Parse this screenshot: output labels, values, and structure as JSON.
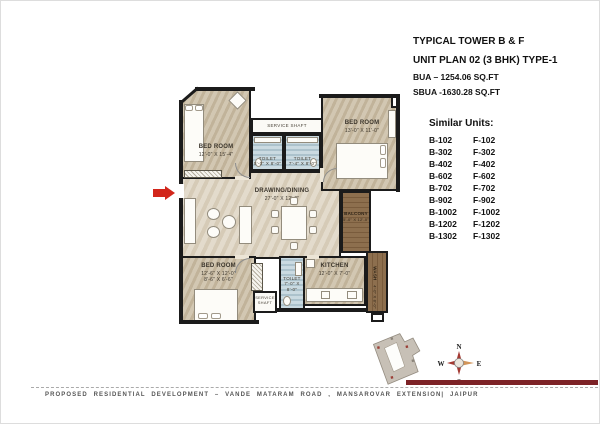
{
  "header": {
    "line1": "TYPICAL TOWER B & F",
    "line2": "UNIT PLAN 02 (3 BHK) TYPE-1",
    "line3": "BUA – 1254.06 SQ.FT",
    "line4": "SBUA -1630.28 SQ.FT"
  },
  "similar_units": {
    "title": "Similar Units:",
    "rows": [
      {
        "b": "B-102",
        "f": "F-102"
      },
      {
        "b": "B-302",
        "f": "F-302"
      },
      {
        "b": "B-402",
        "f": "F-402"
      },
      {
        "b": "B-602",
        "f": "F-602"
      },
      {
        "b": "B-702",
        "f": "F-702"
      },
      {
        "b": "B-902",
        "f": "F-902"
      },
      {
        "b": "B-1002",
        "f": "F-1002"
      },
      {
        "b": "B-1202",
        "f": "F-1202"
      },
      {
        "b": "B-1302",
        "f": "F-1302"
      }
    ]
  },
  "plan": {
    "rooms": {
      "bed_tl": {
        "name": "BED ROOM",
        "dims": "12'-0\" X 15'-4\""
      },
      "bed_tr": {
        "name": "BED ROOM",
        "dims": "13'-0\" X 11'-0\""
      },
      "bed_bl": {
        "name": "BED ROOM",
        "dims": "12'-6\" X 12'-0\"",
        "dims2": "8'-6\" X 6'-6\""
      },
      "drawing": {
        "name": "DRAWING/DINING",
        "dims": "27'-0\" X 12'-0\""
      },
      "balcony": {
        "name": "BALCONY",
        "dims": "5'-0\" X 12'-0\""
      },
      "kitchen": {
        "name": "KITCHEN",
        "dims": "12'-0\" X 7'-0\""
      },
      "toilet_1": {
        "name": "TOILET",
        "dims": "5'-0\" X 8'-0\""
      },
      "toilet_2": {
        "name": "TOILET",
        "dims": "7'-4\" X 8'-0\""
      },
      "toilet_3": {
        "name": "TOILET",
        "dims": "7'-0\" X 8'-0\""
      },
      "wash": {
        "name": "WASH",
        "dims": "4'-0\" X 8'-0\""
      },
      "shaft_top": {
        "name": "SERVICE SHAFT"
      },
      "shaft_bottom": {
        "name": "SERVICE SHAFT"
      }
    }
  },
  "compass": {
    "n": "N",
    "e": "E",
    "s": "S",
    "w": "W"
  },
  "footer": {
    "text": "PROPOSED RESIDENTIAL DEVELOPMENT – VANDE MATARAM ROAD , MANSAROVAR EXTENSION| JAIPUR"
  },
  "colors": {
    "entry_arrow": "#d2261b",
    "footer_bar": "#7d2327",
    "toilet_blue": "#b9ced7",
    "wood": "#8d6f4e",
    "floor_tan": "#cbbea5",
    "compass_red": "#a33a32",
    "compass_east": "#d2955a"
  }
}
